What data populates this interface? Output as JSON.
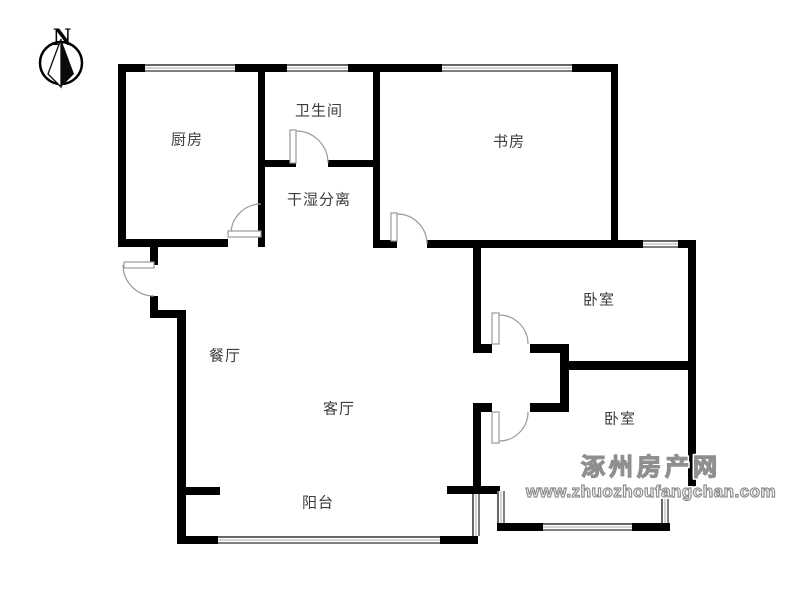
{
  "compass": {
    "letter": "N"
  },
  "rooms": {
    "kitchen": {
      "label": "厨房"
    },
    "bathroom": {
      "label": "卫生间"
    },
    "dry_wet_zone": {
      "label": "干湿分离"
    },
    "study": {
      "label": "书房"
    },
    "bedroom_north": {
      "label": "卧室"
    },
    "bedroom_south": {
      "label": "卧室"
    },
    "dining_room": {
      "label": "餐厅"
    },
    "living_room": {
      "label": "客厅"
    },
    "balcony": {
      "label": "阳台"
    }
  },
  "watermark": {
    "site_name": "涿州房产网",
    "site_url": "www.zhuozhoufangchan.com"
  },
  "colors": {
    "wall": "#000000",
    "door": "#999999",
    "window_frame": "#444444",
    "label_text": "#3d3d3d",
    "watermark_gray": "#8f8f8f",
    "background": "#ffffff"
  }
}
